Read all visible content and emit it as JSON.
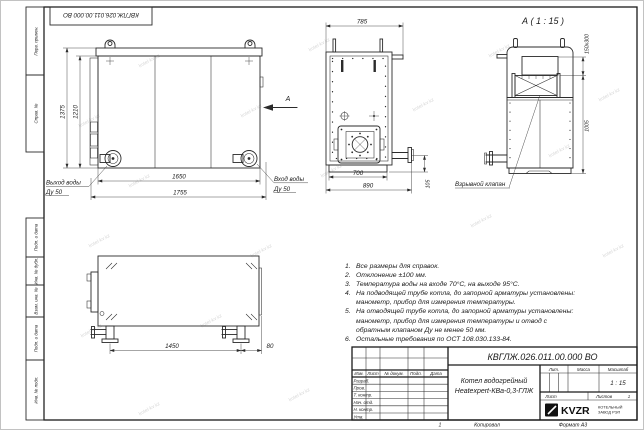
{
  "stamp_top": "КВГЛЖ.026.011.00.000 ВО",
  "watermark": "kotel-kv.kz",
  "colors": {
    "line": "#2b2b2b",
    "paper": "#ffffff",
    "watermark": "#cccccc",
    "logo_black": "#111111"
  },
  "margin_boxes": {
    "perv": "Перв. примен.",
    "sprav": "Справ. №",
    "podp1": "Подп. и дата",
    "inv_dubl": "Инв. № дубл.",
    "vzam": "Взам. инв. №",
    "podp2": "Подп. и дата",
    "inv_podl": "Инв. № подл."
  },
  "front_view": {
    "dim_height_overall": "1375",
    "dim_height_body": "1210",
    "dim_width_inner": "1650",
    "dim_width_overall": "1755",
    "outlet_label_1": "Выход воды",
    "outlet_label_2": "Ду 50",
    "inlet_label_1": "Вход воды",
    "inlet_label_2": "Ду 50",
    "view_arrow_label": "А"
  },
  "side_view": {
    "dim_width_overall": "785",
    "dim_width_body": "700",
    "dim_depth_overall": "890",
    "dim_pipe_height": "105"
  },
  "detail_view": {
    "title": "А ( 1 : 15 )",
    "dim_valve": "150х300",
    "dim_height": "1005",
    "valve_label": "Взрывной клапан"
  },
  "bottom_view": {
    "dim_length": "1450",
    "dim_offset": "80"
  },
  "notes": [
    {
      "num": "1.",
      "text": "Все размеры для справок."
    },
    {
      "num": "2.",
      "text": "Отклонение ±100 мм."
    },
    {
      "num": "3.",
      "text": "Температура воды на входе 70°С, на выходе 95°С."
    },
    {
      "num": "4.",
      "text": "На подводящей трубе котла, до запорной арматуры установлены: манометр, прибор для измерения температуры."
    },
    {
      "num": "5.",
      "text": "На отводящей трубе котла, до запорной арматуры установлены: манометр, прибор для измерения температуры и отвод с обратным клапаном Ду не менее 50 мм."
    },
    {
      "num": "6.",
      "text": "Остальные требования по ОСТ 108.030.133-84."
    }
  ],
  "title_block": {
    "doc_number": "КВГЛЖ.026.011.00.000 ВО",
    "name_line1": "Котел водогрейный",
    "name_line2": "Heatexpert-КВа-0,3-ГЛЖ",
    "col_izm": "Изм.",
    "col_list": "Лист",
    "col_docum": "№ докум.",
    "col_podp": "Подп.",
    "col_data": "Дата",
    "rows": [
      "Разраб.",
      "Пров.",
      "Т. контр.",
      "Нач. отд.",
      "Н. контр.",
      "Утв."
    ],
    "lit": "Лит.",
    "massa": "Масса",
    "masshtab": "Масштаб",
    "scale": "1 : 15",
    "list_label": "Лист",
    "listov_label": "Листов",
    "listov_value": "1",
    "logo_text": "KVZR",
    "company_line1": "КОТЕЛЬНЫЙ",
    "company_line2": "ЗАВОД РЭП",
    "page_num": "1",
    "kopiroval": "Копировал",
    "format": "Формат А3"
  }
}
